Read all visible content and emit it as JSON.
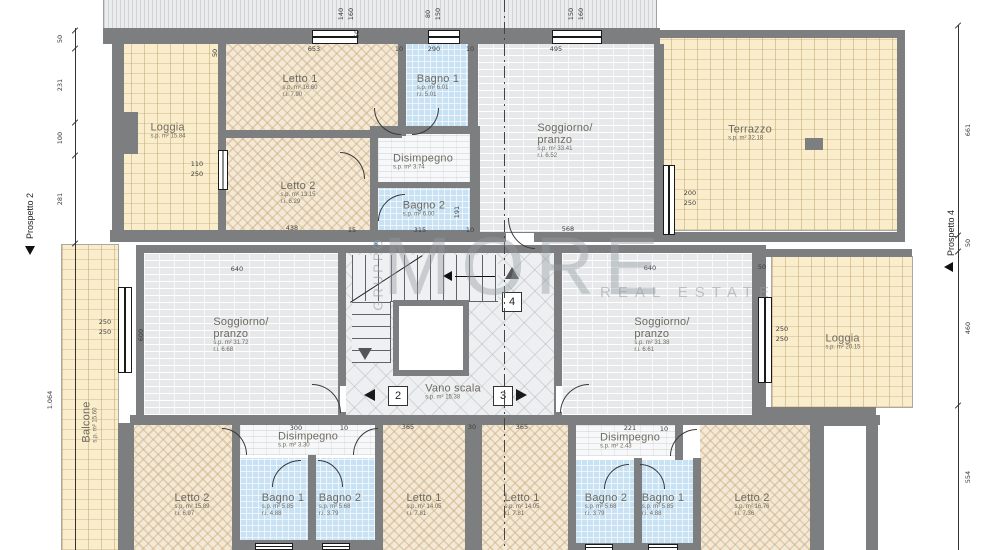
{
  "plan": {
    "watermark": {
      "vertical": "GRUPPO",
      "brand": "MORE",
      "tagline": "REAL ESTATE"
    },
    "prospetto_left": {
      "label": "Prospetto 2",
      "x": 30,
      "y": 216
    },
    "prospetto_right": {
      "label": "Prospetto 4",
      "x": 951,
      "y": 233
    },
    "asterisk": {
      "t": "*",
      "x": 376,
      "y": 246
    },
    "stair_markers": [
      {
        "label": "2",
        "x": 388,
        "y": 386,
        "tri": "left",
        "tx": 364,
        "ty": 389
      },
      {
        "label": "3",
        "x": 493,
        "y": 386,
        "tri": "right",
        "tx": 516,
        "ty": 389
      },
      {
        "label": "4",
        "x": 502,
        "y": 292,
        "tri": "up",
        "tx": 505,
        "ty": 267
      }
    ],
    "rooms": [
      {
        "id": "loggia-top",
        "name": "Loggia",
        "area": "s.p. m² 15.84",
        "x": 118,
        "y": 44,
        "w": 100,
        "h": 190,
        "floor": "tile",
        "lx": 168,
        "ly": 131
      },
      {
        "id": "letto1-top",
        "name": "Letto 1",
        "area": "s.p. m² 16.60",
        "ri": "r.i. 7.90",
        "x": 226,
        "y": 44,
        "w": 172,
        "h": 88,
        "floor": "hatch",
        "lx": 300,
        "ly": 86
      },
      {
        "id": "letto2-top",
        "name": "Letto 2",
        "area": "s.p. m² 13.15",
        "ri": "r.i. 6.29",
        "x": 226,
        "y": 138,
        "w": 172,
        "h": 94,
        "floor": "hatch",
        "lx": 298,
        "ly": 193
      },
      {
        "id": "bagno1-top",
        "name": "Bagno 1",
        "area": "s.p. m² 6.01",
        "ri": "r.i. 5.01",
        "x": 406,
        "y": 44,
        "w": 62,
        "h": 84,
        "floor": "bath",
        "lx": 438,
        "ly": 86
      },
      {
        "id": "disimpegno-top",
        "name": "Disimpegno",
        "area": "s.p. m² 3.74",
        "x": 378,
        "y": 132,
        "w": 92,
        "h": 52,
        "floor": "plain",
        "lx": 423,
        "ly": 162
      },
      {
        "id": "bagno2-top",
        "name": "Bagno 2",
        "area": "s.p. m² 6.00",
        "x": 378,
        "y": 188,
        "w": 92,
        "h": 44,
        "floor": "bath",
        "lx": 424,
        "ly": 209
      },
      {
        "id": "soggiorno-top",
        "name": "Soggiorno/\npranzo",
        "area": "s.p. m² 33.41",
        "ri": "r.i. 6.52",
        "x": 478,
        "y": 44,
        "w": 178,
        "h": 194,
        "floor": "brick",
        "lx": 565,
        "ly": 141
      },
      {
        "id": "terrazzo",
        "name": "Terrazzo",
        "area": "s.p. m² 32.18",
        "x": 658,
        "y": 38,
        "w": 240,
        "h": 192,
        "floor": "tile",
        "lx": 750,
        "ly": 133
      },
      {
        "id": "balcone",
        "name": "Balcone",
        "area": "s.p. m² 15.60",
        "x": 62,
        "y": 245,
        "w": 56,
        "h": 305,
        "floor": "tile",
        "lx": 90,
        "ly": 422,
        "vertical": true
      },
      {
        "id": "soggiorno-left",
        "name": "Soggiorno/\npranzo",
        "area": "s.p. m² 31.72",
        "ri": "r.i. 6.68",
        "x": 144,
        "y": 253,
        "w": 194,
        "h": 162,
        "floor": "brick",
        "lx": 241,
        "ly": 335
      },
      {
        "id": "vano-scala",
        "name": "Vano scala",
        "area": "s.p. m² 15.38",
        "x": 346,
        "y": 253,
        "w": 208,
        "h": 168,
        "floor": "diamond",
        "lx": 453,
        "ly": 392
      },
      {
        "id": "soggiorno-right",
        "name": "Soggiorno/\npranzo",
        "area": "s.p. m² 31.38",
        "ri": "r.i. 6.61",
        "x": 562,
        "y": 253,
        "w": 190,
        "h": 162,
        "floor": "brick",
        "lx": 662,
        "ly": 335
      },
      {
        "id": "loggia-right",
        "name": "Loggia",
        "area": "s.p. m² 20.15",
        "x": 772,
        "y": 257,
        "w": 140,
        "h": 150,
        "floor": "tile",
        "lx": 843,
        "ly": 342
      },
      {
        "id": "letto2-bottom-left",
        "name": "Letto 2",
        "area": "s.p. m² 15.89",
        "ri": "r.i. 6.97",
        "x": 134,
        "y": 423,
        "w": 98,
        "h": 127,
        "floor": "hatch",
        "lx": 192,
        "ly": 505
      },
      {
        "id": "disimpegno-bottom-left",
        "name": "Disimpegno",
        "area": "s.p. m² 3.30",
        "x": 240,
        "y": 423,
        "w": 135,
        "h": 32,
        "floor": "plain",
        "lx": 308,
        "ly": 440
      },
      {
        "id": "bagno1-bottom-left",
        "name": "Bagno 1",
        "area": "s.p. m² 5.85",
        "ri": "r.i. 4.88",
        "x": 240,
        "y": 458,
        "w": 68,
        "h": 92,
        "floor": "bath",
        "lx": 283,
        "ly": 505
      },
      {
        "id": "bagno2-bottom-left",
        "name": "Bagno 2",
        "area": "s.p. m² 5.68",
        "ri": "r.i. 3.79",
        "x": 314,
        "y": 458,
        "w": 61,
        "h": 92,
        "floor": "bath",
        "lx": 340,
        "ly": 505
      },
      {
        "id": "letto1-bottom-left",
        "name": "Letto 1",
        "area": "s.p. m² 14.05",
        "ri": "r.i. 7.81",
        "x": 383,
        "y": 423,
        "w": 82,
        "h": 127,
        "floor": "hatch",
        "lx": 424,
        "ly": 505
      },
      {
        "id": "letto1-bottom-right",
        "name": "Letto 1",
        "area": "s.p. m² 14.05",
        "ri": "r.i. 7.81",
        "x": 482,
        "y": 423,
        "w": 86,
        "h": 127,
        "floor": "hatch",
        "lx": 522,
        "ly": 505
      },
      {
        "id": "disimpegno-bottom-right",
        "name": "Disimpegno",
        "area": "s.p. m² 2.43",
        "x": 575,
        "y": 423,
        "w": 100,
        "h": 33,
        "floor": "plain",
        "lx": 630,
        "ly": 441
      },
      {
        "id": "bagno2-bottom-right",
        "name": "Bagno 2",
        "area": "s.p. m² 5.68",
        "ri": "r.i. 3.79",
        "x": 575,
        "y": 460,
        "w": 59,
        "h": 90,
        "floor": "bath",
        "lx": 606,
        "ly": 505
      },
      {
        "id": "bagno1-bottom-right",
        "name": "Bagno 1",
        "area": "s.p. m² 5.85",
        "ri": "r.i. 4.88",
        "x": 640,
        "y": 460,
        "w": 56,
        "h": 90,
        "floor": "bath",
        "lx": 663,
        "ly": 505
      },
      {
        "id": "letto2-bottom-right",
        "name": "Letto 2",
        "area": "s.p. m² 16.76",
        "ri": "r.i. 7.36",
        "x": 700,
        "y": 423,
        "w": 110,
        "h": 127,
        "floor": "hatch",
        "lx": 752,
        "ly": 505
      }
    ],
    "dims": [
      {
        "t": "50",
        "x": 60,
        "y": 39,
        "r": -90
      },
      {
        "t": "231",
        "x": 60,
        "y": 85,
        "r": -90
      },
      {
        "t": "100",
        "x": 60,
        "y": 138,
        "r": -90
      },
      {
        "t": "281",
        "x": 60,
        "y": 199,
        "r": -90
      },
      {
        "t": "1.064",
        "x": 50,
        "y": 400,
        "r": -90
      },
      {
        "t": "661",
        "x": 968,
        "y": 130,
        "r": -90
      },
      {
        "t": "50",
        "x": 968,
        "y": 243,
        "r": -90
      },
      {
        "t": "460",
        "x": 968,
        "y": 328,
        "r": -90
      },
      {
        "t": "554",
        "x": 968,
        "y": 477,
        "r": -90
      },
      {
        "t": "653",
        "x": 314,
        "y": 49
      },
      {
        "t": "10",
        "x": 399,
        "y": 49
      },
      {
        "t": "290",
        "x": 434,
        "y": 49
      },
      {
        "t": "10",
        "x": 470,
        "y": 49
      },
      {
        "t": "495",
        "x": 556,
        "y": 49
      },
      {
        "t": "50",
        "x": 215,
        "y": 53,
        "r": -90
      },
      {
        "t": "50",
        "x": 357,
        "y": 34,
        "r": -90
      },
      {
        "t": "140",
        "x": 341,
        "y": 14,
        "r": -90
      },
      {
        "t": "160",
        "x": 351,
        "y": 14,
        "r": -90
      },
      {
        "t": "80",
        "x": 428,
        "y": 14,
        "r": -90
      },
      {
        "t": "150",
        "x": 438,
        "y": 14,
        "r": -90
      },
      {
        "t": "150",
        "x": 571,
        "y": 14,
        "r": -90
      },
      {
        "t": "160",
        "x": 581,
        "y": 14,
        "r": -90
      },
      {
        "t": "110",
        "x": 197,
        "y": 164
      },
      {
        "t": "250",
        "x": 197,
        "y": 174
      },
      {
        "t": "200",
        "x": 690,
        "y": 193
      },
      {
        "t": "250",
        "x": 690,
        "y": 203
      },
      {
        "t": "438",
        "x": 292,
        "y": 228
      },
      {
        "t": "15",
        "x": 352,
        "y": 230
      },
      {
        "t": "315",
        "x": 420,
        "y": 230
      },
      {
        "t": "10",
        "x": 470,
        "y": 230
      },
      {
        "t": "191",
        "x": 457,
        "y": 212,
        "r": -90
      },
      {
        "t": "568",
        "x": 568,
        "y": 229
      },
      {
        "t": "640",
        "x": 237,
        "y": 269
      },
      {
        "t": "640",
        "x": 650,
        "y": 268
      },
      {
        "t": "50",
        "x": 762,
        "y": 267
      },
      {
        "t": "600",
        "x": 141,
        "y": 335,
        "r": -90
      },
      {
        "t": "250",
        "x": 105,
        "y": 322
      },
      {
        "t": "250",
        "x": 105,
        "y": 332
      },
      {
        "t": "250",
        "x": 782,
        "y": 329
      },
      {
        "t": "250",
        "x": 782,
        "y": 339
      },
      {
        "t": "300",
        "x": 296,
        "y": 428
      },
      {
        "t": "10",
        "x": 344,
        "y": 428
      },
      {
        "t": "365",
        "x": 408,
        "y": 427
      },
      {
        "t": "30",
        "x": 472,
        "y": 427
      },
      {
        "t": "365",
        "x": 522,
        "y": 427
      },
      {
        "t": "221",
        "x": 630,
        "y": 428
      },
      {
        "t": "10",
        "x": 664,
        "y": 429
      }
    ]
  }
}
